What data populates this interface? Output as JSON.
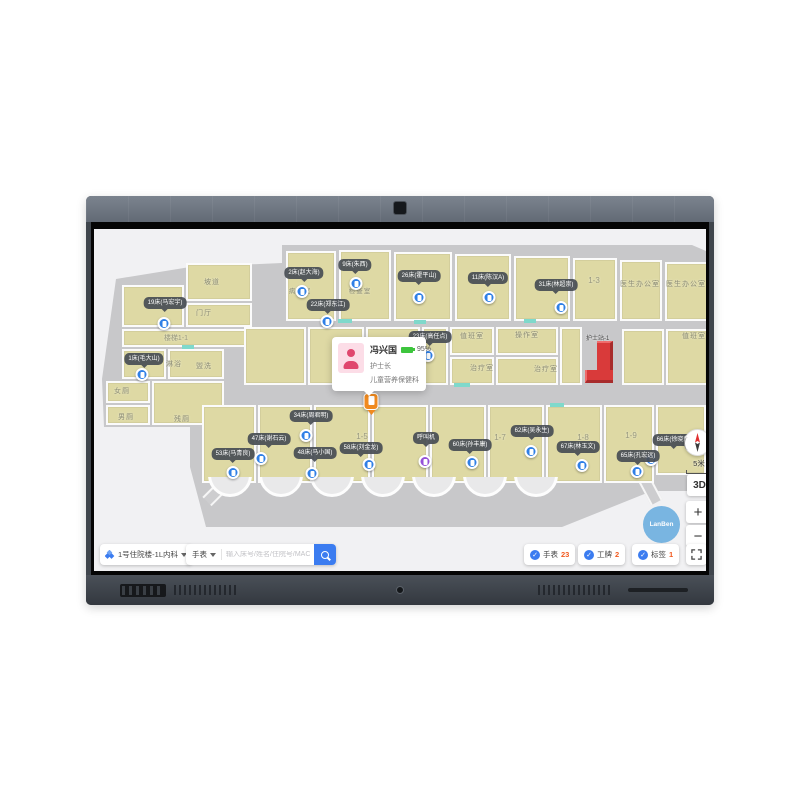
{
  "toolbar": {
    "area_selector": {
      "label": "1号住院楼-1L内科"
    },
    "device_type_label": "手表",
    "search_placeholder": "输入床号/姓名/住院号/MAC地址",
    "counters": [
      {
        "label": "手表",
        "value": "23"
      },
      {
        "label": "工牌",
        "value": "2"
      },
      {
        "label": "标签",
        "value": "1"
      }
    ]
  },
  "popup": {
    "name": "冯兴国",
    "battery": "95%",
    "title": "护士长",
    "department": "儿童营养保健科"
  },
  "controls": {
    "scale": "5米",
    "mode_3d": "3D",
    "zoom_in": "+",
    "zoom_out": "−",
    "brand": "LanBen"
  },
  "map": {
    "nurse_station_label": "护士站-1",
    "call_tag": {
      "label": "呼叫机"
    },
    "beds": [
      {
        "label": "2床(赵大海)"
      },
      {
        "label": "9床(朱西)"
      },
      {
        "label": "22床(郑东江)"
      },
      {
        "label": "26床(霍平山)"
      },
      {
        "label": "11床(陈汉A)"
      },
      {
        "label": "31床(林超崇)"
      },
      {
        "label": "19床(马宏宇)"
      },
      {
        "label": "1床(毛大山)"
      },
      {
        "label": "23床(高任点)"
      },
      {
        "label": "34床(周君明)"
      },
      {
        "label": "47床(谢石云)"
      },
      {
        "label": "53床(马青良)"
      },
      {
        "label": "48床(马小国)"
      },
      {
        "label": "58床(刘金龙)"
      },
      {
        "label": "60床(孙丰康)"
      },
      {
        "label": "62床(吴永生)"
      },
      {
        "label": "67床(林玉文)"
      },
      {
        "label": "65床(孔宏远)"
      },
      {
        "label": "66床(徐晓荣)"
      }
    ],
    "rooms": [
      {
        "label": "坡道"
      },
      {
        "label": "门厅"
      },
      {
        "label": "楼梯1-1"
      },
      {
        "label": "淋浴"
      },
      {
        "label": "盥洗"
      },
      {
        "label": "女厕"
      },
      {
        "label": "男厕"
      },
      {
        "label": "残厕"
      },
      {
        "label": "病房室"
      },
      {
        "label": "检查室"
      },
      {
        "label": "1-3"
      },
      {
        "label": "医生办公室"
      },
      {
        "label": "医生办公室"
      },
      {
        "label": "值班室"
      },
      {
        "label": "操作室"
      },
      {
        "label": "治疗室"
      },
      {
        "label": "治疗室"
      },
      {
        "label": "值班室"
      },
      {
        "label": "1-5"
      },
      {
        "label": "1-7"
      },
      {
        "label": "1-8"
      },
      {
        "label": "1-9"
      }
    ]
  },
  "colors": {
    "accent_blue": "#3b7cf0",
    "count_orange": "#f25a1f",
    "pin_blue": "#2f7fe6",
    "pin_purple": "#9550d8",
    "selected_orange": "#f08a1f",
    "station_red": "#d93a3a",
    "battery_green": "#3dc53d"
  }
}
